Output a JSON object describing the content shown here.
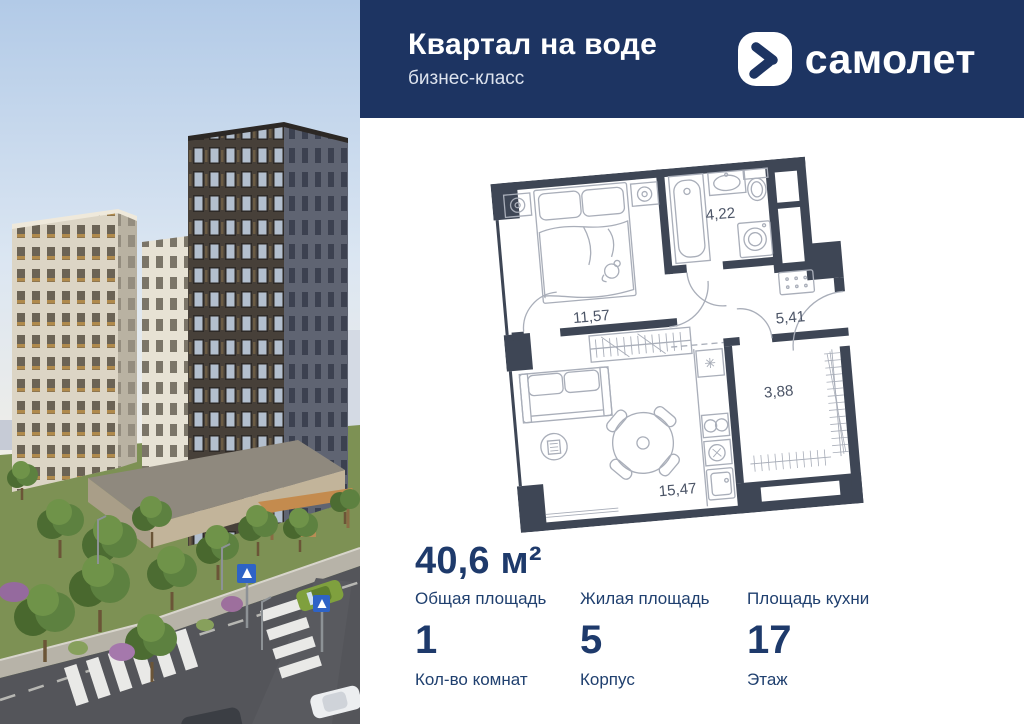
{
  "header": {
    "title": "Квартал на воде",
    "subtitle": "бизнес-класс",
    "brand": "самолет"
  },
  "floor_plan": {
    "areas": {
      "bedroom": "11,57",
      "bathroom": "4,22",
      "hallway": "5,41",
      "living": "15,47",
      "wardrobe": "3,88"
    }
  },
  "details": {
    "total_area": {
      "value": "40,6 м²",
      "label": "Общая площадь"
    },
    "living_area_label": "Жилая площадь",
    "kitchen_area_label": "Площадь кухни",
    "rooms": {
      "value": "1",
      "label": "Кол-во комнат"
    },
    "building": {
      "value": "5",
      "label": "Корпус"
    },
    "floor": {
      "value": "17",
      "label": "Этаж"
    }
  },
  "colors": {
    "header_bg": "#1d3462",
    "text_navy": "#1e3a6b",
    "plan_wall": "#3e4655"
  }
}
